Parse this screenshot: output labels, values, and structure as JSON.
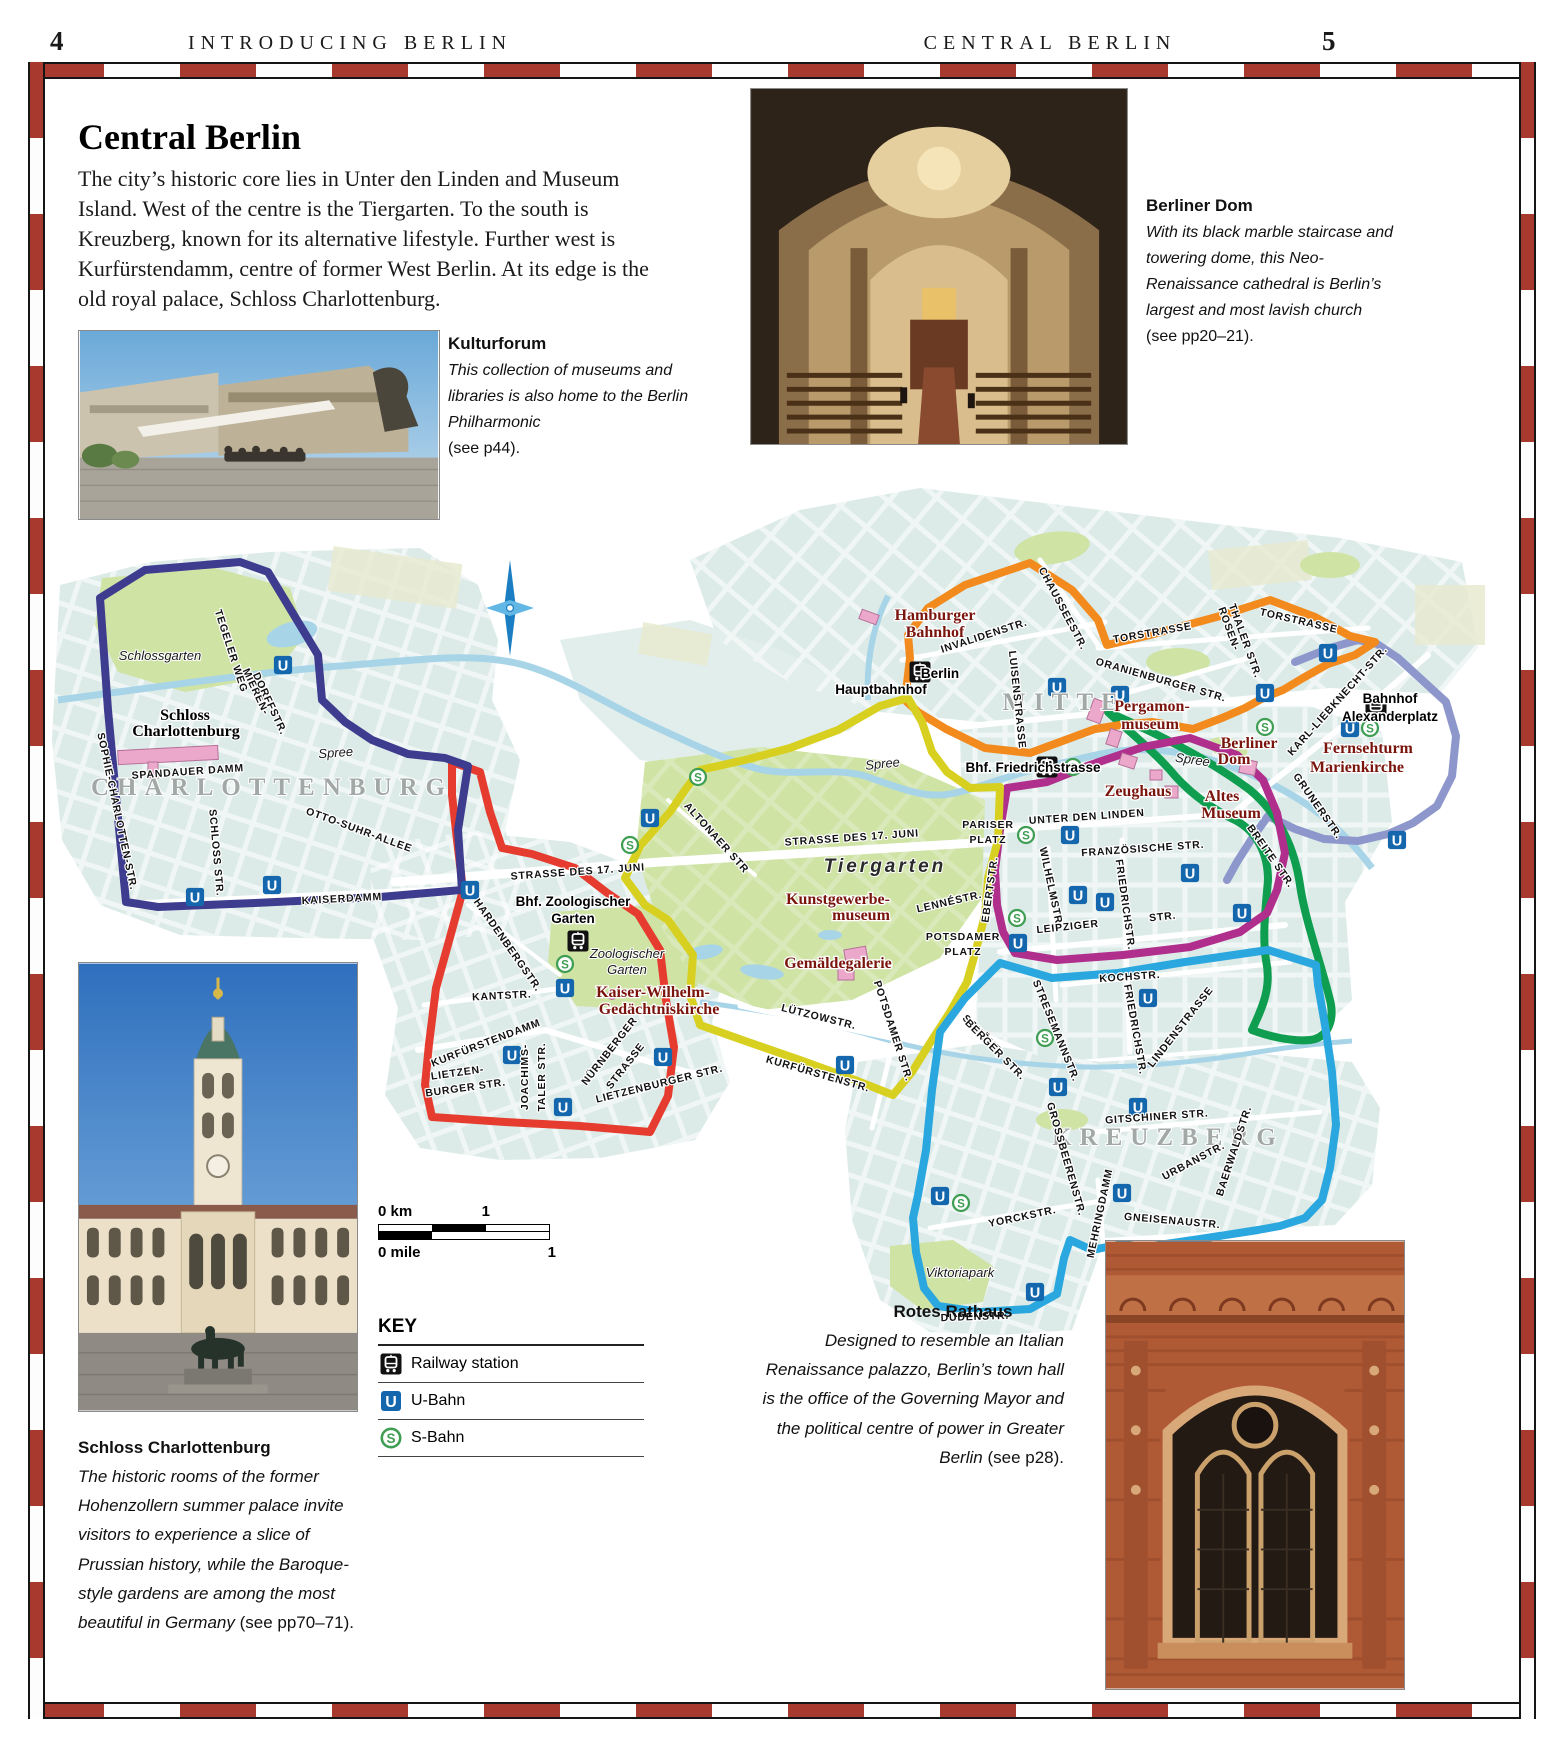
{
  "header": {
    "page_left": "4",
    "section_left": "INTRODUCING BERLIN",
    "section_right": "CENTRAL BERLIN",
    "page_right": "5"
  },
  "intro": {
    "title": "Central Berlin",
    "body": "The city’s historic core lies in Unter den Linden and Museum Island. West of the centre is the Tiergarten. To the south is Kreuzberg, known for its alternative lifestyle. Further west is Kurfürstendamm, centre of former West Berlin. At its edge is the old royal palace, Schloss Charlottenburg."
  },
  "captions": {
    "kulturforum": {
      "title": "Kulturforum",
      "body": "This collection of museums and libraries is also home to the Berlin Philharmonic",
      "ref": "(see p44)."
    },
    "berliner_dom": {
      "title": "Berliner Dom",
      "body": "With its black marble staircase and towering dome, this Neo-Renaissance cathedral is Berlin’s largest and most lavish church",
      "ref": "(see pp20–21)."
    },
    "schloss": {
      "title": "Schloss Charlottenburg",
      "body": "The historic rooms of the former Hohenzollern summer palace invite visitors to experience a slice of Prussian history, while the Baroque-style gardens are among the most beautiful in Germany",
      "ref": "(see pp70–71)."
    },
    "rotes_rathaus": {
      "title": "Rotes Rathaus",
      "body": "Designed to resemble an Italian Renaissance palazzo, Berlin’s town hall is the office of the Governing Mayor and the political centre of power in Greater Berlin",
      "ref": "(see p28)."
    }
  },
  "scale": {
    "km_zero": "0 km",
    "km_one": "1",
    "mile_zero": "0 mile",
    "mile_one": "1"
  },
  "key": {
    "title": "KEY",
    "items": [
      {
        "sym": "rail",
        "icon": "railway-station-icon",
        "label": "Railway station"
      },
      {
        "sym": "u",
        "icon": "u-bahn-icon",
        "label": "U-Bahn"
      },
      {
        "sym": "s",
        "icon": "s-bahn-icon",
        "label": "S-Bahn"
      }
    ]
  },
  "map": {
    "route_colors": {
      "navy": "#3d3c8e",
      "red": "#e63c2f",
      "yellow": "#d8d021",
      "magenta": "#b02e8c",
      "orange": "#f28a1d",
      "periwinkle": "#8d97cb",
      "green": "#0f9d4f",
      "lightblue": "#2ba7df"
    },
    "badge_colors": {
      "u_bahn": "#1467ad",
      "s_bahn": "#3f9e53",
      "rail": "#111111"
    },
    "labels": [
      [
        "CHARLOTTENBURG",
        272,
        795,
        0,
        "ar"
      ],
      [
        "MITTE",
        1064,
        710,
        0,
        "ar"
      ],
      [
        "KREUZBERG",
        1168,
        1145,
        0,
        "ar"
      ],
      [
        "Tiergarten",
        885,
        872,
        0,
        "tg"
      ],
      [
        "Schlossgarten",
        160,
        660,
        0,
        "it"
      ],
      [
        "Spree",
        336,
        757,
        -4,
        "it"
      ],
      [
        "Spree",
        883,
        768,
        -6,
        "it"
      ],
      [
        "Spree",
        1192,
        764,
        8,
        "it"
      ],
      [
        "Zoologischer",
        627,
        958,
        0,
        "it"
      ],
      [
        "Garten",
        627,
        974,
        0,
        "it"
      ],
      [
        "Viktoriapark",
        960,
        1277,
        0,
        "it"
      ],
      [
        "Schloss",
        185,
        720,
        0,
        "sb"
      ],
      [
        "Charlottenburg",
        186,
        736,
        0,
        "sb"
      ],
      [
        "Hamburger",
        935,
        620,
        0,
        "si",
        "e"
      ],
      [
        "Bahnhof",
        935,
        637,
        0,
        "si",
        "e"
      ],
      [
        "Pergamon-",
        1152,
        711,
        0,
        "si"
      ],
      [
        "museum",
        1150,
        729,
        0,
        "si"
      ],
      [
        "Berliner",
        1249,
        748,
        0,
        "si"
      ],
      [
        "Dom",
        1234,
        764,
        0,
        "si"
      ],
      [
        "Zeughaus",
        1138,
        796,
        0,
        "si"
      ],
      [
        "Altes",
        1222,
        801,
        0,
        "si"
      ],
      [
        "Museum",
        1231,
        818,
        0,
        "si"
      ],
      [
        "Fernsehturm",
        1368,
        753,
        0,
        "si"
      ],
      [
        "Marienkirche",
        1357,
        772,
        0,
        "si"
      ],
      [
        "Kunstgewerbe-",
        838,
        904,
        0,
        "si"
      ],
      [
        "museum",
        861,
        920,
        0,
        "si"
      ],
      [
        "Gemäldegalerie",
        838,
        968,
        0,
        "si"
      ],
      [
        "Kaiser-Wilhelm-",
        653,
        997,
        0,
        "si"
      ],
      [
        "Gedächtniskirche",
        659,
        1014,
        0,
        "si"
      ],
      [
        "Berlin",
        940,
        678,
        0,
        "sn",
        "s"
      ],
      [
        "Hauptbahnhof",
        881,
        694,
        0,
        "sn",
        "s"
      ],
      [
        "Bhf. Friedrichstrasse",
        1033,
        772,
        0,
        "sn",
        "e"
      ],
      [
        "Bahnhof",
        1390,
        703,
        0,
        "sn",
        "s"
      ],
      [
        "Alexanderplatz",
        1390,
        721,
        0,
        "sn",
        "s"
      ],
      [
        "Bhf. Zoologischer",
        573,
        906,
        0,
        "sn"
      ],
      [
        "Garten",
        573,
        923,
        0,
        "sn"
      ],
      [
        "TEGELER WEG",
        228,
        652,
        72,
        "st"
      ],
      [
        "MIEREN-",
        253,
        693,
        65,
        "st"
      ],
      [
        "DORFFSTR.",
        267,
        705,
        65,
        "st"
      ],
      [
        "SOPHIE-CHARLOTTEN-STR.",
        114,
        812,
        78,
        "st"
      ],
      [
        "SPANDAUER DAMM",
        188,
        775,
        -4,
        "st"
      ],
      [
        "SCHLOSS STR.",
        213,
        853,
        85,
        "st"
      ],
      [
        "OTTO-SUHR-ALLEE",
        358,
        833,
        20,
        "st"
      ],
      [
        "KAISERDAMM",
        342,
        902,
        -3,
        "st"
      ],
      [
        "HARDENBERGSTR.",
        505,
        947,
        55,
        "st"
      ],
      [
        "KANTSTR.",
        502,
        999,
        -3,
        "st"
      ],
      [
        "KURFÜRSTENDAMM",
        487,
        1046,
        -21,
        "st"
      ],
      [
        "LIETZEN-",
        458,
        1076,
        -8,
        "st"
      ],
      [
        "BURGER STR.",
        466,
        1091,
        -8,
        "st"
      ],
      [
        "JOACHIMS-",
        528,
        1077,
        -90,
        "st"
      ],
      [
        "TALER STR.",
        545,
        1077,
        -90,
        "st"
      ],
      [
        "NÜRNBERGER",
        612,
        1053,
        -52,
        "st"
      ],
      [
        "STRASSE",
        628,
        1068,
        -52,
        "st"
      ],
      [
        "LIETZENBURGER STR.",
        660,
        1087,
        -14,
        "st"
      ],
      [
        "STRASSE DES 17. JUNI",
        578,
        875,
        -4,
        "st"
      ],
      [
        "STRASSE DES 17. JUNI",
        852,
        841,
        -4,
        "st"
      ],
      [
        "ALTONAER STR",
        714,
        840,
        48,
        "st"
      ],
      [
        "INVALIDENSTR.",
        985,
        639,
        -18,
        "st"
      ],
      [
        "LUISENSTRASSE",
        1014,
        700,
        84,
        "st"
      ],
      [
        "CHAUSSEESTR.",
        1060,
        610,
        62,
        "st"
      ],
      [
        "TORSTRASSE",
        1153,
        636,
        -10,
        "st"
      ],
      [
        "TORSTRASSE",
        1298,
        624,
        13,
        "st"
      ],
      [
        "ROSEN-",
        1226,
        630,
        70,
        "st"
      ],
      [
        "THALER STR.",
        1242,
        642,
        70,
        "st"
      ],
      [
        "ORANIENBURGER STR.",
        1160,
        683,
        16,
        "st"
      ],
      [
        "KARL-LIEBKNECHT-STR.",
        1340,
        703,
        -48,
        "st"
      ],
      [
        "GRUNERSTR.",
        1315,
        808,
        55,
        "st"
      ],
      [
        "BREITE STR.",
        1268,
        858,
        55,
        "st"
      ],
      [
        "UNTER DEN LINDEN",
        1087,
        820,
        -4,
        "st"
      ],
      [
        "FRANZÖSISCHE STR.",
        1143,
        852,
        -4,
        "st"
      ],
      [
        "WILHELMSTR.",
        1048,
        888,
        78,
        "st"
      ],
      [
        "FRIEDRICHSTR.",
        1122,
        905,
        82,
        "st"
      ],
      [
        "EBERTSTR.",
        993,
        890,
        -82,
        "st"
      ],
      [
        "LENNÉSTR.",
        950,
        905,
        -13,
        "st"
      ],
      [
        "PARISER",
        988,
        828,
        0,
        "st"
      ],
      [
        "PLATZ",
        988,
        843,
        0,
        "st"
      ],
      [
        "POTSDAMER",
        963,
        940,
        0,
        "st"
      ],
      [
        "PLATZ",
        963,
        955,
        0,
        "st"
      ],
      [
        "LEIPZIGER",
        1068,
        930,
        -6,
        "st"
      ],
      [
        "STR.",
        1163,
        920,
        -6,
        "st"
      ],
      [
        "KOCHSTR.",
        1130,
        980,
        -4,
        "st"
      ],
      [
        "STRESEMANNSTR.",
        1053,
        1032,
        68,
        "st"
      ],
      [
        "SCHÖNE-",
        981,
        1038,
        45,
        "st"
      ],
      [
        "BERGER STR.",
        993,
        1052,
        45,
        "st"
      ],
      [
        "LÜTZOWSTR.",
        818,
        1020,
        14,
        "st"
      ],
      [
        "KURFÜRSTENSTR.",
        817,
        1077,
        16,
        "st"
      ],
      [
        "POTSDAMER STR.",
        890,
        1032,
        72,
        "st"
      ],
      [
        "FRIEDRICHSTR.",
        1132,
        1030,
        80,
        "st"
      ],
      [
        "LINDENSTRASSE",
        1183,
        1029,
        -52,
        "st"
      ],
      [
        "GROSSBEERENSTR.",
        1063,
        1160,
        74,
        "st"
      ],
      [
        "YORCKSTR.",
        1023,
        1220,
        -12,
        "st"
      ],
      [
        "MEHRINGDAMM",
        1103,
        1214,
        -78,
        "st"
      ],
      [
        "GNEISENAUSTR.",
        1172,
        1224,
        5,
        "st"
      ],
      [
        "URBANSTR.",
        1195,
        1164,
        -28,
        "st"
      ],
      [
        "BAERWALDSTR.",
        1237,
        1152,
        -72,
        "st"
      ],
      [
        "GITSCHINER STR.",
        1157,
        1120,
        -4,
        "st"
      ],
      [
        "DUDENSTR.",
        975,
        1320,
        -2,
        "st"
      ]
    ],
    "badges": [
      [
        "U",
        283,
        665
      ],
      [
        "U",
        195,
        897
      ],
      [
        "U",
        272,
        885
      ],
      [
        "U",
        470,
        890
      ],
      [
        "U",
        565,
        988
      ],
      [
        "U",
        512,
        1055
      ],
      [
        "U",
        563,
        1107
      ],
      [
        "U",
        663,
        1057
      ],
      [
        "U",
        650,
        818
      ],
      [
        "U",
        845,
        1065
      ],
      [
        "U",
        1058,
        1087
      ],
      [
        "U",
        940,
        1196
      ],
      [
        "U",
        1035,
        1292
      ],
      [
        "U",
        1122,
        1193
      ],
      [
        "U",
        1138,
        1107
      ],
      [
        "U",
        1148,
        998
      ],
      [
        "U",
        1078,
        895
      ],
      [
        "U",
        1105,
        902
      ],
      [
        "U",
        1018,
        943
      ],
      [
        "U",
        1070,
        835
      ],
      [
        "U",
        1190,
        873
      ],
      [
        "U",
        1242,
        913
      ],
      [
        "U",
        1057,
        687
      ],
      [
        "U",
        1120,
        695
      ],
      [
        "U",
        1265,
        693
      ],
      [
        "U",
        1328,
        653
      ],
      [
        "U",
        1350,
        728
      ],
      [
        "U",
        1397,
        840
      ],
      [
        "S",
        698,
        777
      ],
      [
        "S",
        630,
        845
      ],
      [
        "S",
        565,
        964
      ],
      [
        "S",
        1017,
        918
      ],
      [
        "S",
        1073,
        767
      ],
      [
        "S",
        1265,
        727
      ],
      [
        "S",
        1370,
        728
      ],
      [
        "S",
        961,
        1203
      ],
      [
        "S",
        1045,
        1038
      ],
      [
        "S",
        1026,
        835
      ],
      [
        "R",
        920,
        672
      ],
      [
        "R",
        1047,
        767
      ],
      [
        "R",
        1376,
        707
      ],
      [
        "R",
        578,
        941
      ]
    ]
  }
}
